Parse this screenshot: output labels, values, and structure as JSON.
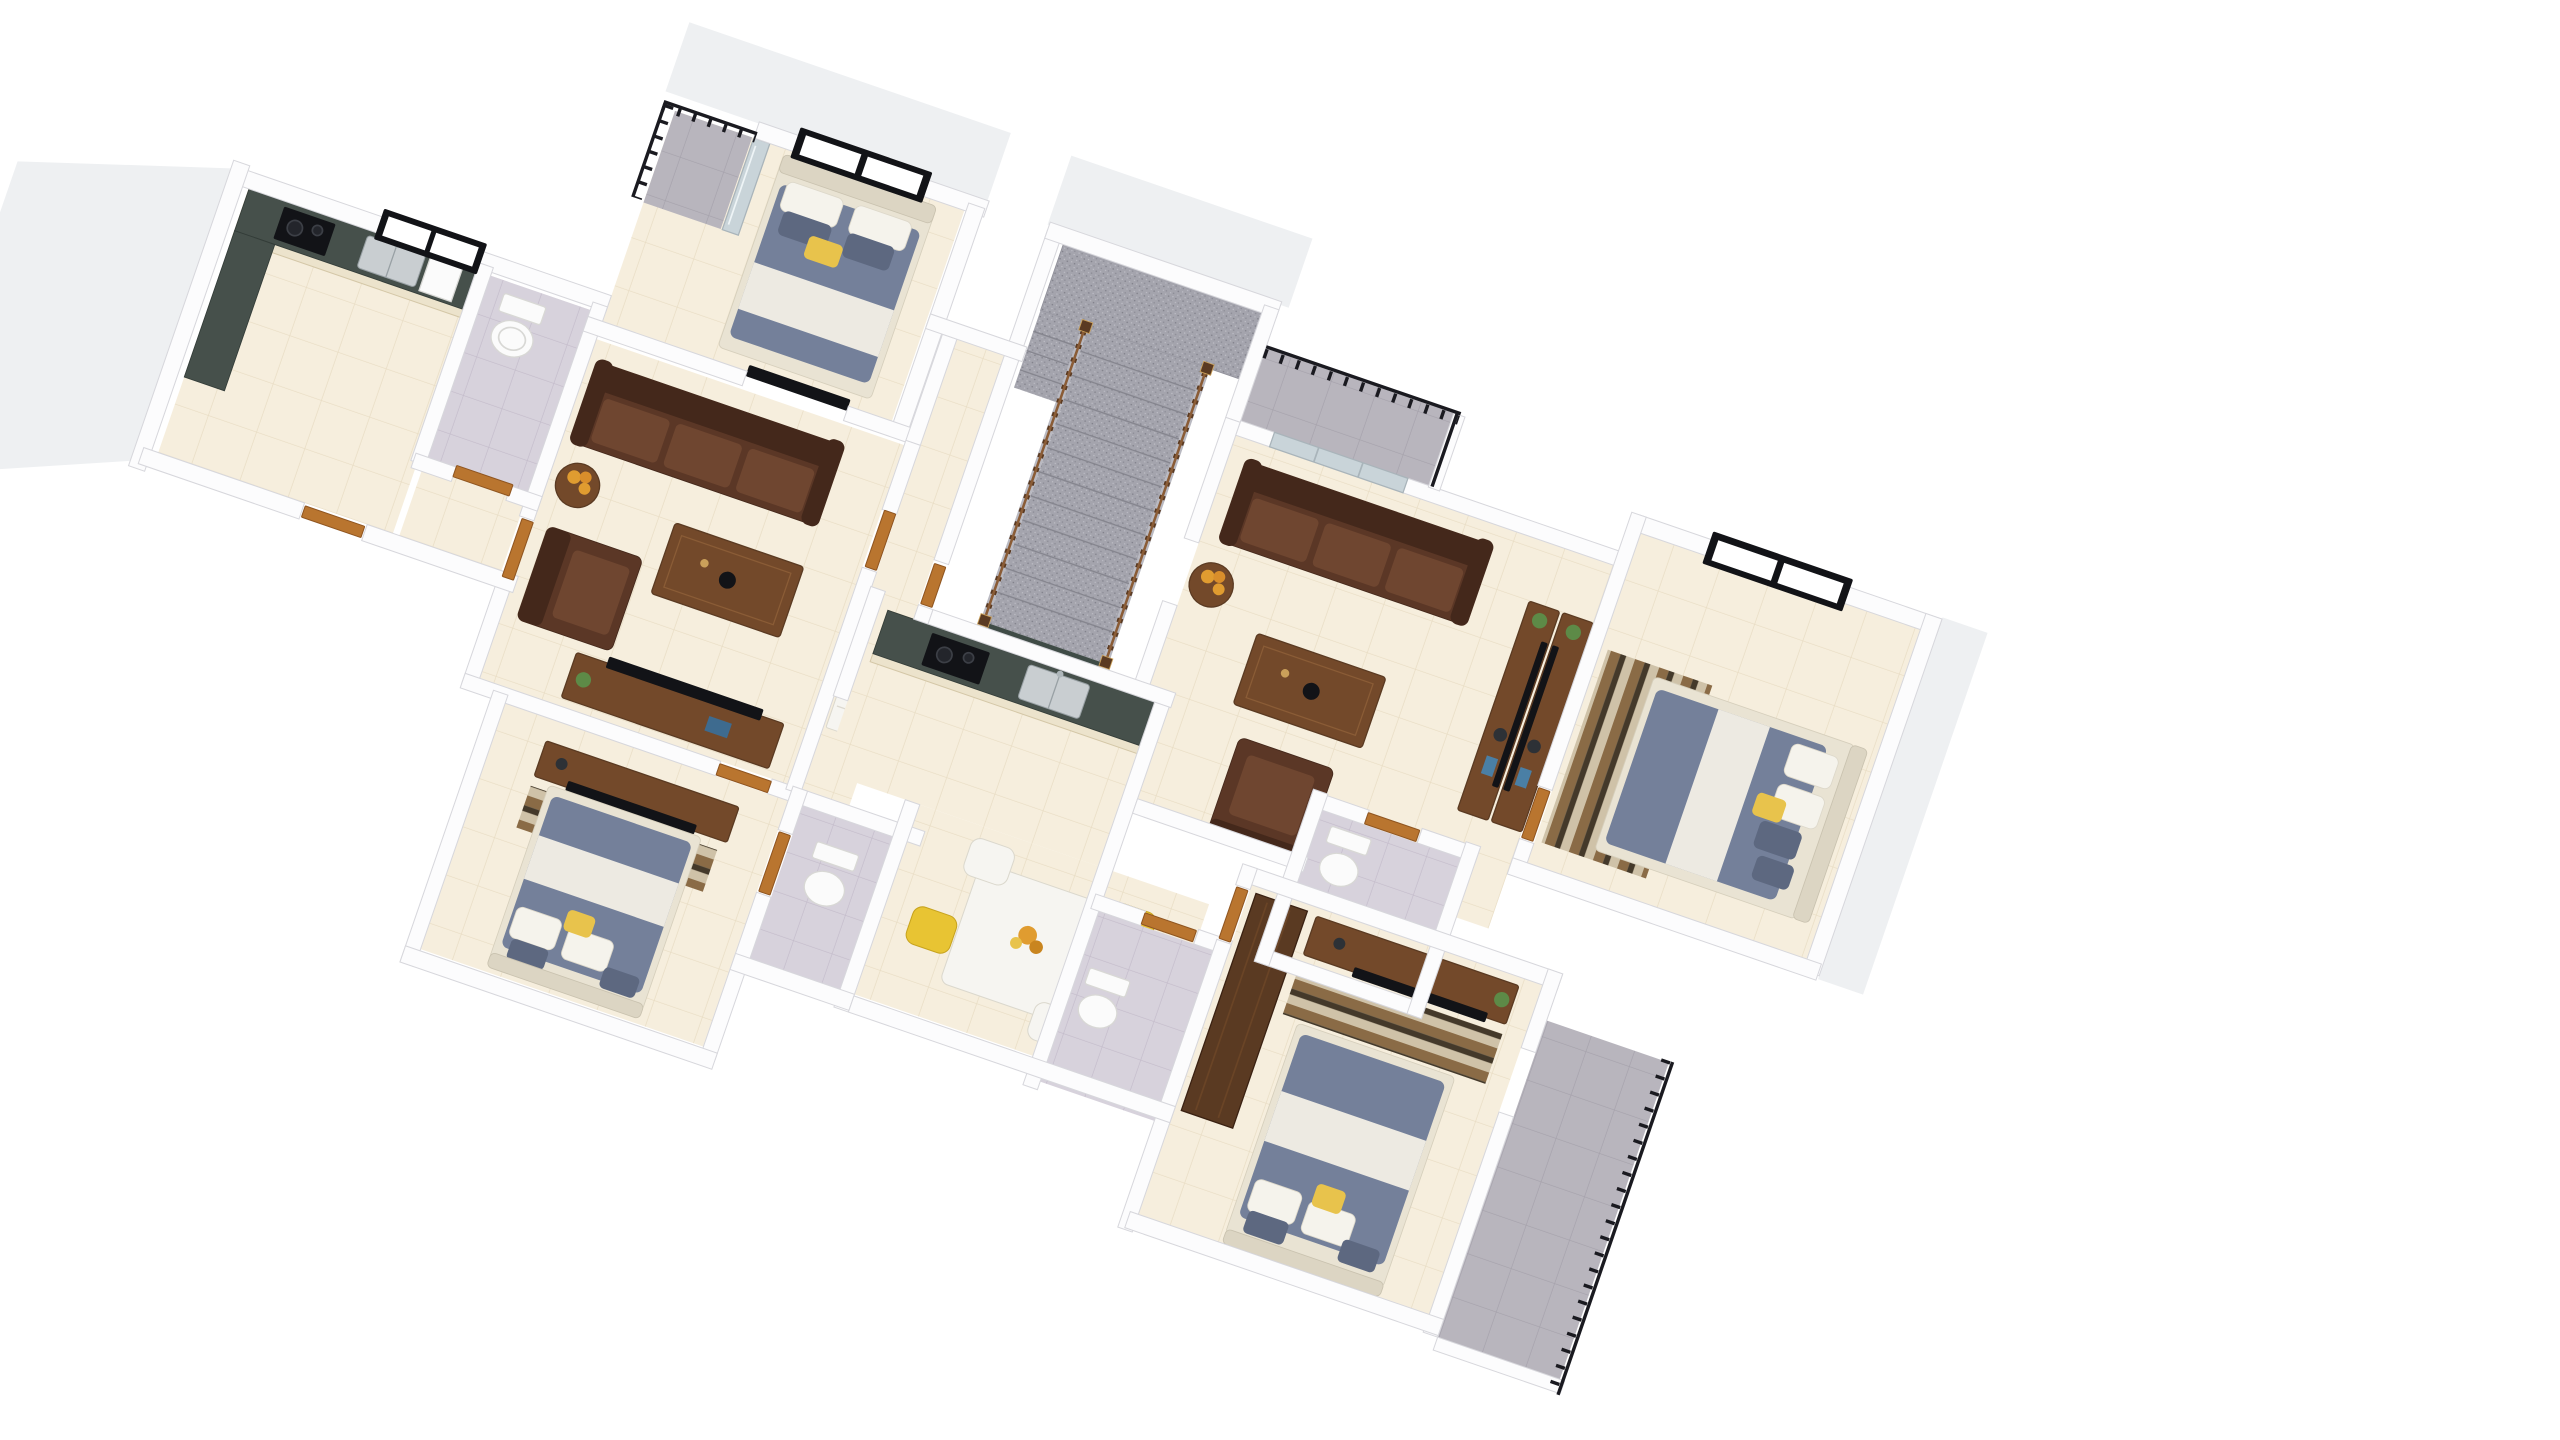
{
  "scene": {
    "kind": "3d-floor-plan-render",
    "view": "rotated-isometric-top-down",
    "rotation_deg": 19,
    "background": "#ffffff",
    "visible_text": "none"
  },
  "colors": {
    "wall": "#fcfcfd",
    "wall_edge": "#d7d7dc",
    "wall_shadow": "#eef0f2",
    "floor_cream": "#f6eedd",
    "floor_line": "#e8dcc3",
    "tile_gray": "#d7d2dc",
    "tile_gray_line": "#c3bbca",
    "balcony_tile": "#b8b5bd",
    "balcony_line": "#a5a1ab",
    "stair": "#a4a4ad",
    "stair_line": "#86868f",
    "railing": "#1a1a20",
    "wood_dark": "#5a3a22",
    "wood_mid": "#73492a",
    "wood_light": "#8a5c36",
    "leather": "#5b3726",
    "leather_dark": "#44281b",
    "leather_light": "#6f4630",
    "door": "#b9752f",
    "door_dark": "#8f5520",
    "counter_dark": "#46504b",
    "cabinet_cream": "#ece3cc",
    "cabinet_line": "#d4c7a7",
    "steel": "#c9ced1",
    "black": "#121317",
    "bed_blue": "#74809a",
    "bed_blue_dark": "#5d6880",
    "blanket": "#edeae2",
    "pillow": "#f5f3ec",
    "yellow": "#e8c34c",
    "headboard": "#dcd5c3",
    "bedbase": "#e9e3d3",
    "rug_dark": "#44392a",
    "rug_tan": "#8a6b46",
    "rug_cream": "#cfc2a8",
    "mirror": "#c9d4d9",
    "plant": "#5d8a47",
    "plant_dark": "#3f6b33",
    "flower": "#e09c30",
    "white_furn": "#f6f5f1",
    "chair_yellow": "#e8c433",
    "marble_green": "#3f4b46",
    "porcelain": "#fbfbfb",
    "porcelain_shadow": "#d8d8d5"
  },
  "rooms": [
    {
      "id": "kitchen-a",
      "label": "Kitchen"
    },
    {
      "id": "bathroom-a",
      "label": "Bathroom"
    },
    {
      "id": "bedroom-1",
      "label": "Bedroom 1"
    },
    {
      "id": "balcony-1",
      "label": "Balcony 1"
    },
    {
      "id": "living-room-1",
      "label": "Living Room 1"
    },
    {
      "id": "bedroom-2",
      "label": "Bedroom 2"
    },
    {
      "id": "bathroom-2",
      "label": "Bathroom 2"
    },
    {
      "id": "corridor",
      "label": "Corridor"
    },
    {
      "id": "staircase",
      "label": "Staircase"
    },
    {
      "id": "balcony-2",
      "label": "Balcony 2"
    },
    {
      "id": "living-room-2",
      "label": "Living Room 2"
    },
    {
      "id": "kitchen-b",
      "label": "Kitchen 2"
    },
    {
      "id": "dining-area",
      "label": "Dining Area"
    },
    {
      "id": "bathroom-3",
      "label": "Bathroom 3"
    },
    {
      "id": "bathroom-4",
      "label": "Bathroom 4"
    },
    {
      "id": "bedroom-3",
      "label": "Bedroom 3"
    },
    {
      "id": "bedroom-4",
      "label": "Bedroom 4"
    },
    {
      "id": "balcony-4",
      "label": "Balcony 4"
    }
  ],
  "furniture": [
    "double-bed",
    "sofa-3-seat",
    "armchair",
    "coffee-table",
    "side-table",
    "tv-stand",
    "flat-tv",
    "wardrobe",
    "mirror-sliding-wardrobe",
    "dining-table",
    "dining-chair",
    "kitchen-counter",
    "gas-cooktop",
    "double-sink",
    "toilet",
    "striped-rug",
    "granite-staircase",
    "wood-balustrade",
    "metal-railing",
    "potted-plant",
    "flower-vase",
    "white-dresser",
    "balcony-glass-door"
  ]
}
